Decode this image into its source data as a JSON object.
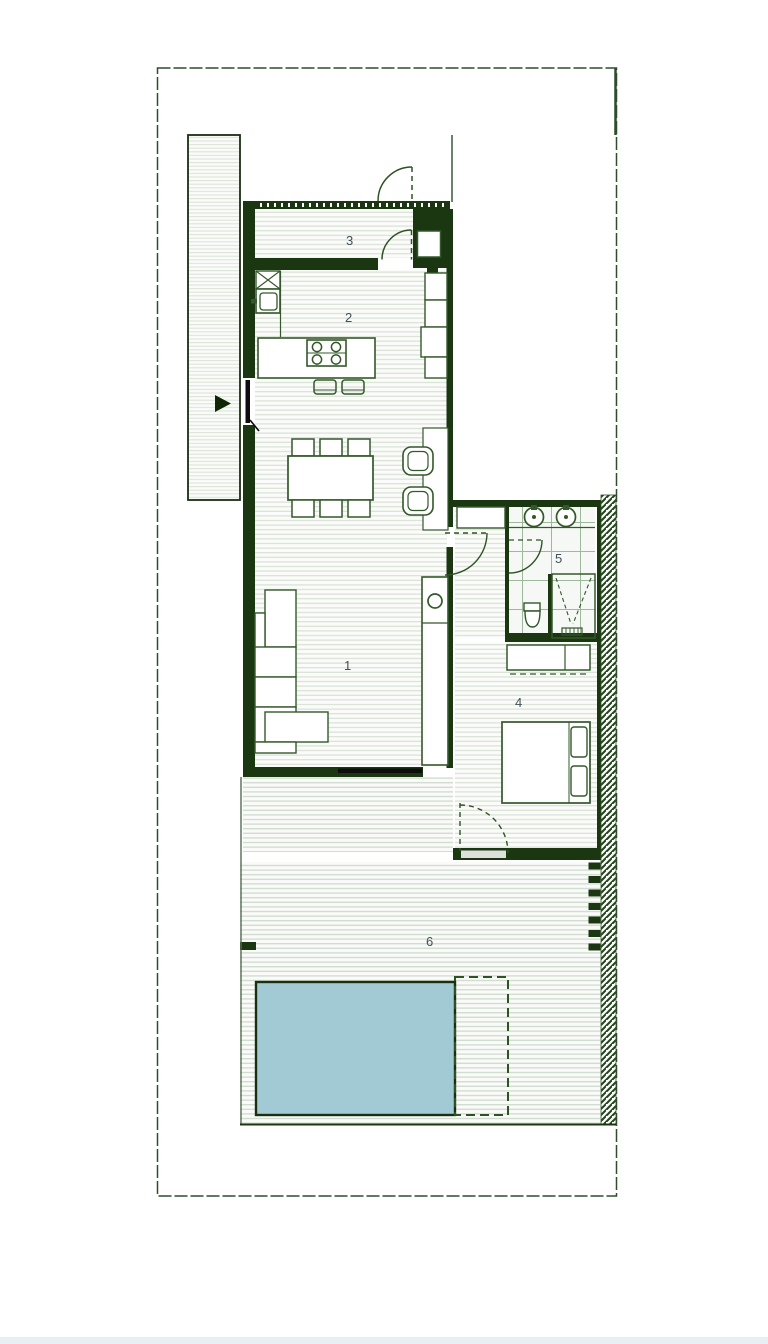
{
  "plan": {
    "type": "architectural-floor-plan",
    "room_labels": [
      {
        "room": "living-area",
        "text": "1"
      },
      {
        "room": "kitchen",
        "text": "2"
      },
      {
        "room": "entry-hall",
        "text": "3"
      },
      {
        "room": "bedroom",
        "text": "4"
      },
      {
        "room": "bathroom",
        "text": "5"
      },
      {
        "room": "terrace",
        "text": "6"
      }
    ],
    "colors": {
      "wall": "#1b3712",
      "wall_black": "#0d0d0d",
      "furniture_stroke": "#33582a",
      "floor_line": "#d8e1d6",
      "terrace_line": "#d2ddd1",
      "tile_line": "#9db89a",
      "hatch": "#24461d",
      "boundary": "#2d4d2b",
      "pool_fill": "#a2cad4",
      "pool_border": "#1c2e12",
      "label": "#415159",
      "footer_strip": "#e9eef3"
    }
  }
}
